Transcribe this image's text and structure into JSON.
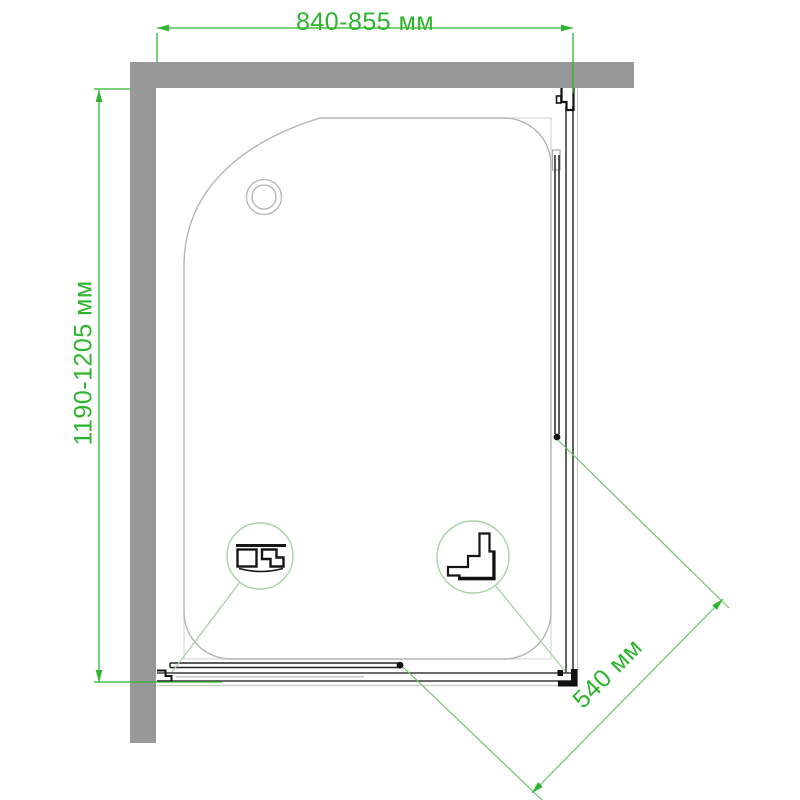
{
  "drawing": {
    "kind": "shower-enclosure-top-view-plan"
  },
  "dimensions": {
    "width_label": "840-855 мм",
    "depth_label": "1190-1205 мм",
    "entry_label": "540 мм"
  },
  "icons": {
    "drain": "drain-circle-icon",
    "detail_1": "wall-profile-section-icon",
    "detail_2": "corner-profile-section-icon"
  },
  "colors": {
    "dimension_green": "#2db42d",
    "diagonal_green": "#6cc46c",
    "leader_green": "#a8d2a8",
    "wall_gray": "#989898",
    "tray_outline_gray": "#b5b5b5",
    "frame_dark": "#1a1a1a"
  }
}
